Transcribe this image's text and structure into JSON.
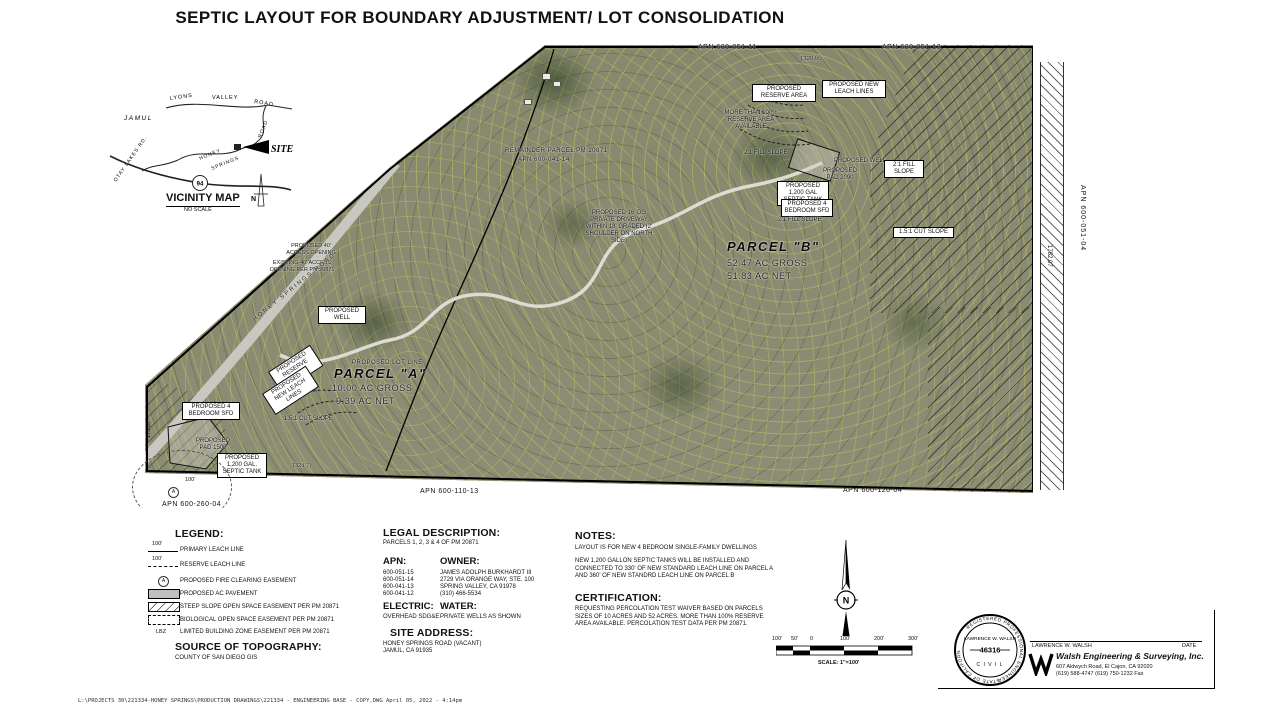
{
  "title": "SEPTIC LAYOUT FOR BOUNDARY ADJUSTMENT/ LOT CONSOLIDATION",
  "vicinity": {
    "title": "VICINITY MAP",
    "subtitle": "NO SCALE",
    "labels": {
      "lyons": "LYONS",
      "valley": "VALLEY",
      "road": "ROAD",
      "jamul": "JAMUL",
      "honey": "HONEY",
      "springs": "SPRINGS",
      "road2": "ROAD",
      "hwy": "94",
      "otay": "OTAY LAKES RD.",
      "site": "SITE",
      "north": "N"
    }
  },
  "map": {
    "labels": {
      "remainder_parcel": "REMAINDER PARCEL PM 20871",
      "remainder_apn": "APN 600-041-14",
      "reserve_area_b": "PROPOSED RESERVE AREA",
      "leach_lines_b": "PROPOSED NEW LEACH LINES",
      "more_reserve": "MORE THAN 100% RESERVE AREA AVAILABLE",
      "fill_slope_left": "2:1 FILL SLOPE",
      "well_b": "PROPOSED WELL",
      "pad_b": "PROPOSED PAD 2090",
      "fill_slope_right": "2:1 FILL SLOPE",
      "septic_b": "PROPOSED 1,200 GAL SEPTIC TANK",
      "sfd_b": "PROPOSED 4 BEDROOM SFD",
      "fill_slope_bottom": "2:1 FILL SLOPE",
      "cut_slope_b": "1.5:1 CUT SLOPE",
      "parcelb_name": "PARCEL \"B\"",
      "parcelb_gross": "52.47 AC GROSS",
      "parcelb_net": "51.83 AC NET",
      "driveway_mid": "PROPOSED 16' DG PRIVATE DRIVEWAY WITHIN 18' GRADED (2' SHOULDER ON NORTH SIDE)",
      "access_proposed": "PROPOSED 40' ACCESS OPENING",
      "access_existing": "EXISTING 40' ACCESS OPENING PER PM 20871",
      "honey_road": "HONEY SPRINGS ROAD",
      "well_a": "PROPOSED WELL",
      "lot_line": "PROPOSED LOT LINE",
      "parcela_name": "PARCEL \"A\"",
      "parcela_gross": "10.00 AC GROSS",
      "parcela_net": "9.39 AC NET",
      "reserve_area_a": "PROPOSED RESERVE AREA",
      "leach_lines_a": "PROPOSED NEW LEACH LINES",
      "sfd_a": "PROPOSED 4 BEDROOM SFD",
      "cut_slope_a": "1.5:1 CUT SLOPE",
      "pad_a": "PROPOSED PAD 1500",
      "septic_a": "PROPOSED 1,200 GAL. SEPTIC TANK",
      "apn_top_left": "APN 600-051-11",
      "apn_top_right": "APN 600-051-13",
      "apn_right": "APN 600-051-04",
      "apn_bottom_left": "APN 600-260-04",
      "apn_bottom_mid": "APN 600-110-13",
      "apn_bottom_right": "APN 600-120-04",
      "dim_top": "1320.60",
      "dim_right": "1782.07",
      "dim_bottom": "1324.77",
      "dim_left": "173.07",
      "fire_radius": "100'"
    }
  },
  "legend": {
    "heading": "LEGEND:",
    "items": [
      {
        "tag": "100'",
        "label": "PRIMARY LEACH LINE"
      },
      {
        "tag": "100'",
        "label": "RESERVE LEACH LINE"
      },
      {
        "tag": "A",
        "label": "PROPOSED FIRE CLEARING EASEMENT"
      },
      {
        "tag": "",
        "label": "PROPOSED AC PAVEMENT"
      },
      {
        "tag": "",
        "label": "STEEP SLOPE OPEN SPACE EASEMENT PER PM 20871"
      },
      {
        "tag": "",
        "label": "BIOLOGICAL OPEN SPACE EASEMENT PER PM 20871"
      },
      {
        "tag": "LBZ",
        "label": "LIMITED BUILDING ZONE EASEMENT PER PM 20871"
      }
    ]
  },
  "topography": {
    "heading": "SOURCE OF TOPOGRAPHY:",
    "body": "COUNTY OF SAN DIEGO GIS"
  },
  "legal": {
    "heading": "LEGAL DESCRIPTION:",
    "body": "PARCELS 1, 2, 3 & 4 OF PM 20871"
  },
  "apn": {
    "heading": "APN:",
    "numbers": [
      "600-051-15",
      "600-051-14",
      "600-041-13",
      "600-041-12"
    ]
  },
  "owner": {
    "heading": "OWNER:",
    "lines": [
      "JAMES ADOLPH BURKHARDT III",
      "2729 VIA ORANGE WAY, STE. 100",
      "SPRING VALLEY, CA 91978",
      "(310) 466-5534"
    ]
  },
  "electric": {
    "heading": "ELECTRIC:",
    "value": "OVERHEAD SDG&E"
  },
  "water": {
    "heading": "WATER:",
    "value": "PRIVATE WELLS AS SHOWN"
  },
  "site_address": {
    "heading": "SITE ADDRESS:",
    "lines": [
      "HONEY SPRINGS ROAD (VACANT)",
      "JAMUL, CA 91935"
    ]
  },
  "notes": {
    "heading": "NOTES:",
    "line1": "LAYOUT IS FOR NEW 4 BEDROOM SINGLE-FAMILY DWELLINGS",
    "line2": "NEW 1,200 GALLON SEPTIC TANKS WILL BE INSTALLED AND CONNECTED TO 330' OF NEW STANDARD LEACH LINE ON PARCEL A AND 360' OF NEW STANDRD LEACH LINE ON PARCEL B"
  },
  "certification": {
    "heading": "CERTIFICATION:",
    "body": "REQUESTING PERCOLATION TEST WAIVER BASED ON PARCELS SIZES OF 10 ACRES AND 52 ACRES. MORE THAN 100% RESERVE AREA AVAILABLE. PERCOLATION TEST DATA PER PM 20871."
  },
  "north_arrow": {
    "n": "N"
  },
  "scalebar": {
    "labels": [
      "100'",
      "50'",
      "0",
      "100'",
      "200'",
      "300'"
    ],
    "caption": "SCALE: 1\"=100'"
  },
  "seal": {
    "ring_top": "REGISTERED PROFESSIONAL ENGINEER",
    "name": "LAWRENCE W. WALSH",
    "number": "46316",
    "discipline": "C I V I L",
    "ring_bottom": "STATE OF CALIFORNIA"
  },
  "firm": {
    "engineer": "LAWRENCE W. WALSH",
    "date_label": "DATE",
    "name": "Walsh Engineering & Surveying, Inc.",
    "address": "607 Aldwych Road, El Cajon, CA 92020",
    "phone": "(619) 588-4747  (619) 750-1232 Fax"
  },
  "footer": "L:\\PROJECTS 30\\221334-HONEY SPRINGS\\PRODUCTION DRAWINGS\\221334 - ENGINEERING BASE - COPY.DWG  April 05, 2022 - 4:14pm",
  "colors": {
    "photo_base": "#85876f",
    "contour": "#d7d25a",
    "hatch": "#444444",
    "pavement": "#bfbfbf"
  }
}
